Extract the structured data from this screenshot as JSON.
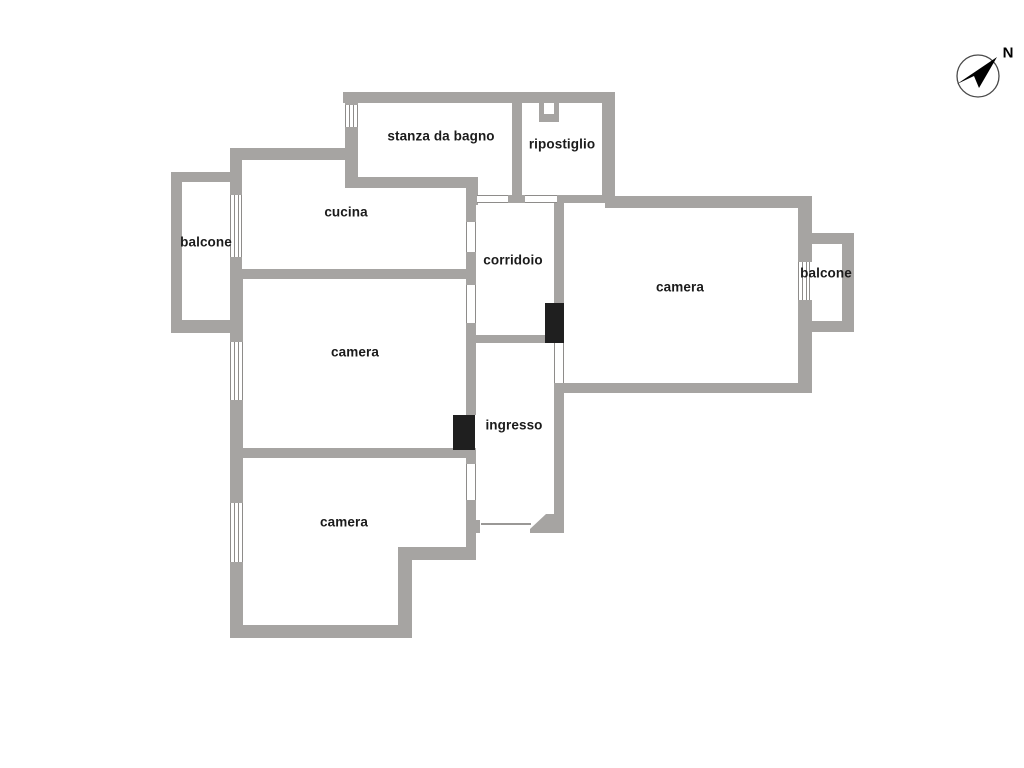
{
  "title": "floor-plan",
  "colors": {
    "wall_fill": "#a6a4a2",
    "wall_outline": "#8e8c8a",
    "opening_line": "#8e8c8a",
    "door_leaf": "#1f1f1f",
    "text_color": "#1b1b1b",
    "background": "#ffffff",
    "compass_stroke": "#4a4a4a"
  },
  "compass": {
    "label": "N"
  },
  "rooms": [
    {
      "id": "stanza-da-bagno",
      "label": "stanza da bagno"
    },
    {
      "id": "ripostiglio",
      "label": "ripostiglio"
    },
    {
      "id": "cucina",
      "label": "cucina"
    },
    {
      "id": "balcone-left",
      "label": "balcone"
    },
    {
      "id": "corridoio",
      "label": "corridoio"
    },
    {
      "id": "camera-right",
      "label": "camera"
    },
    {
      "id": "balcone-right",
      "label": "balcone"
    },
    {
      "id": "camera-middle",
      "label": "camera"
    },
    {
      "id": "ingresso",
      "label": "ingresso"
    },
    {
      "id": "camera-bottom",
      "label": "camera"
    }
  ]
}
